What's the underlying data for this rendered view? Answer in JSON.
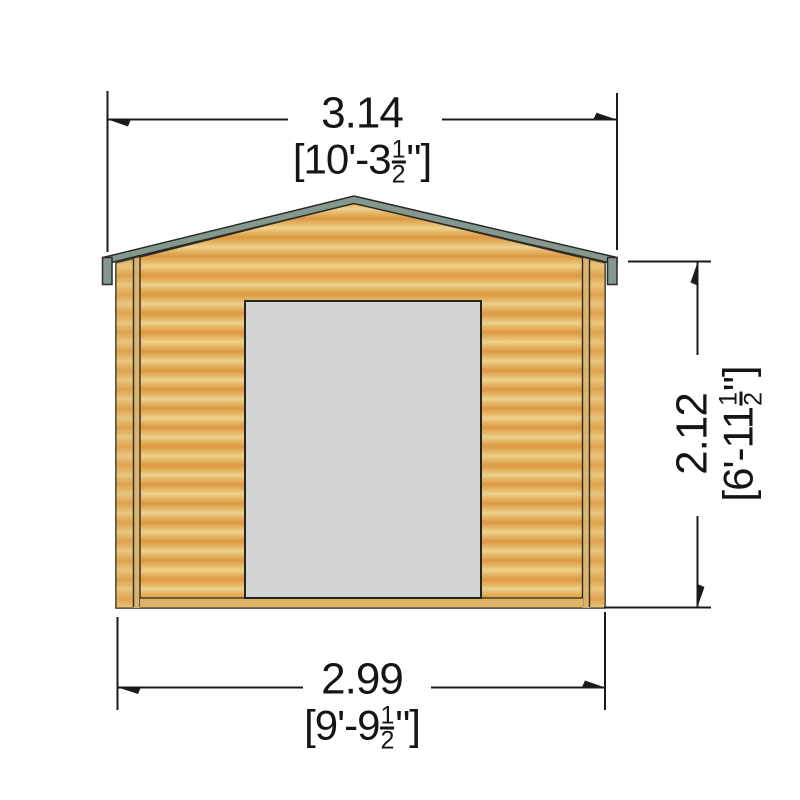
{
  "figure": {
    "type": "technical-drawing",
    "subject": "log cabin front elevation with overall dimensions"
  },
  "dimensions": {
    "top": {
      "metric": "3.14",
      "imperial_open": "[10'-3",
      "frac_num": "1",
      "frac_den": "2",
      "imperial_close": "\"]"
    },
    "bottom": {
      "metric": "2.99",
      "imperial_open": "[9'-9",
      "frac_num": "1",
      "frac_den": "2",
      "imperial_close": "\"]"
    },
    "right": {
      "metric": "2.12",
      "imperial_open": "[6'-11",
      "frac_num": "1",
      "frac_den": "2",
      "imperial_close": "\"]"
    }
  },
  "colors": {
    "wood_light": "#ecd18c",
    "wood_mid": "#e5b363",
    "wood_dark": "#dd9840",
    "corner_strip": "#dcb46d",
    "base_band": "#dfb266",
    "roof_trim": "#85988f",
    "door": "#d3d4d6",
    "outline": "#2c2c26",
    "line": "#1b1b1b"
  }
}
